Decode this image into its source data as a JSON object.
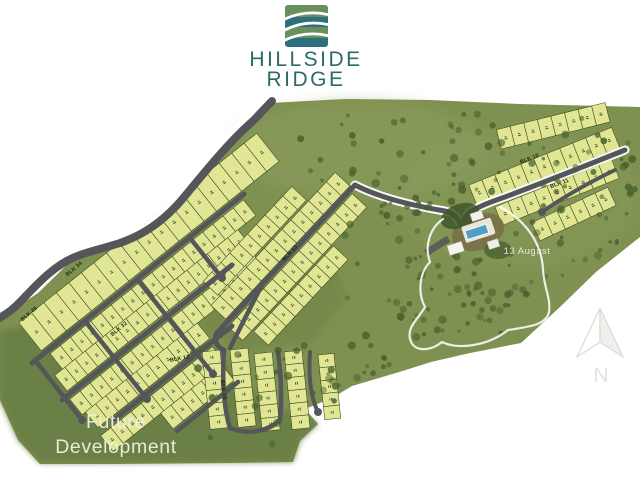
{
  "header": {
    "title_line1": "HILLSIDE",
    "title_line2": "RIDGE"
  },
  "map": {
    "future_label_1": "Future",
    "future_label_2": "Development",
    "date_annotation": "13 August",
    "north_label": "N",
    "block_labels": [
      {
        "text": "BLK 34",
        "x": 75,
        "y": 270,
        "rot": -40
      },
      {
        "text": "BLK 35",
        "x": 30,
        "y": 315,
        "rot": -40
      },
      {
        "text": "BLK 32",
        "x": 120,
        "y": 330,
        "rot": -40
      },
      {
        "text": "BLK 23",
        "x": 291,
        "y": 254,
        "rot": -47
      },
      {
        "text": "BLK 12",
        "x": 180,
        "y": 360,
        "rot": -10
      },
      {
        "text": "BLK 25",
        "x": 222,
        "y": 390,
        "rot": 82
      },
      {
        "text": "BLK 10",
        "x": 530,
        "y": 160,
        "rot": -22
      },
      {
        "text": "BLK 11",
        "x": 560,
        "y": 185,
        "rot": -20
      }
    ],
    "colors": {
      "site_green": "#7e9150",
      "open_dark": "#6b7f45",
      "wedge_green": "#71854a",
      "light_green": "#8d9e60",
      "lot_fill": "#e1e694",
      "lot_stroke": "#3a451f",
      "road": "#55565a",
      "tree_green": "#45602c",
      "pool_blue": "#4e9fc7",
      "brand_teal": "#2c6a66",
      "logo_green": "#69905c",
      "logo_teal": "#2e6f7f"
    }
  }
}
